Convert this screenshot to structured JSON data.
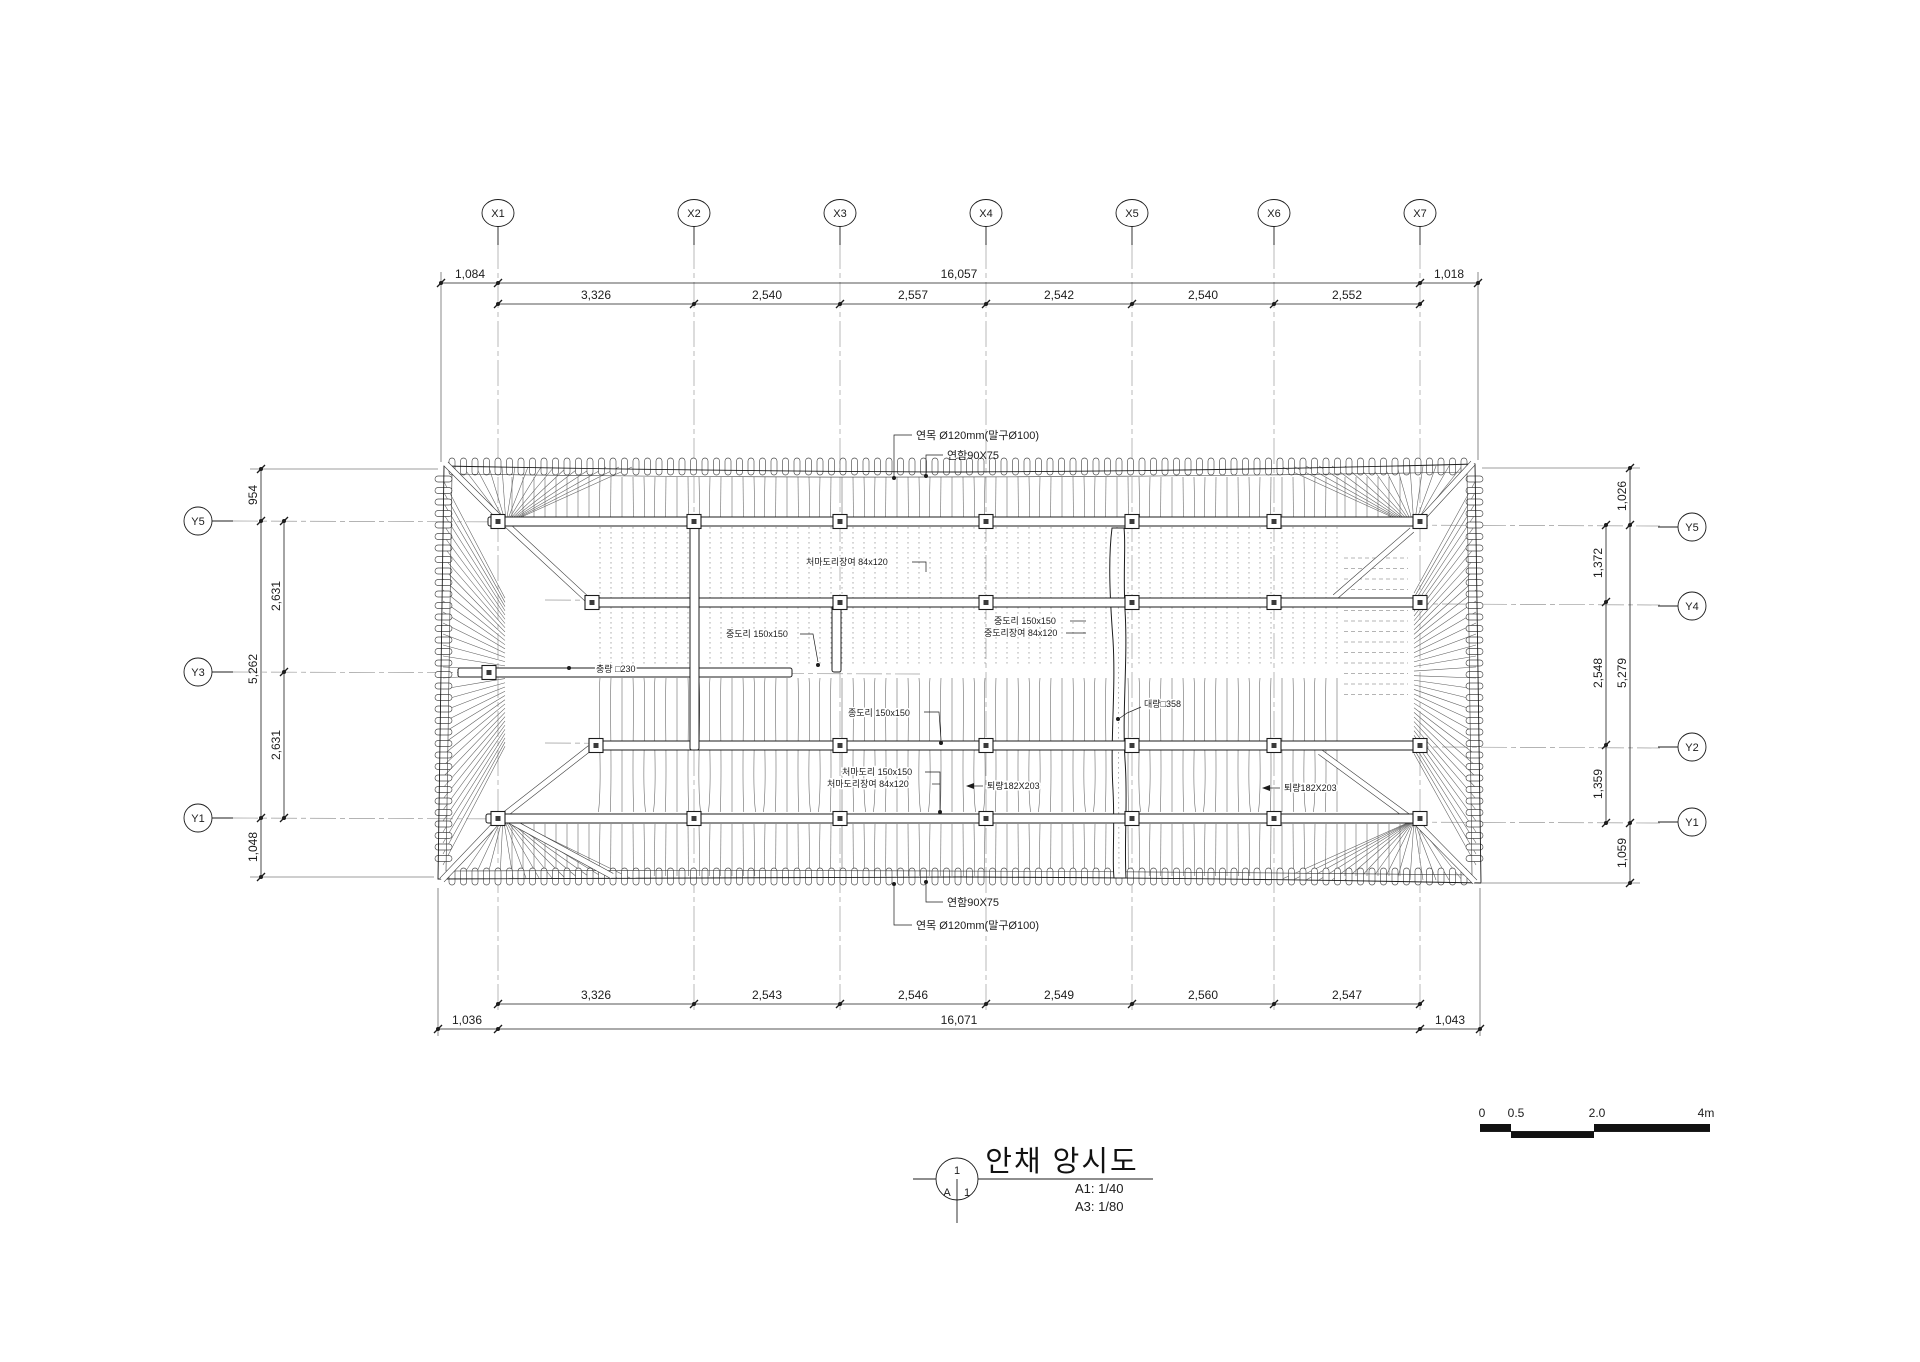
{
  "grid": {
    "x": [
      "X1",
      "X2",
      "X3",
      "X4",
      "X5",
      "X6",
      "X7"
    ],
    "y_left": [
      "Y5",
      "Y3",
      "Y1"
    ],
    "y_right": [
      "Y5",
      "Y4",
      "Y2",
      "Y1"
    ]
  },
  "dims": {
    "top_outer": [
      "1,084",
      "16,057",
      "1,018"
    ],
    "top_inner": [
      "3,326",
      "2,540",
      "2,557",
      "2,542",
      "2,540",
      "2,552"
    ],
    "bottom_inner": [
      "3,326",
      "2,543",
      "2,546",
      "2,549",
      "2,560",
      "2,547"
    ],
    "bottom_outer": [
      "1,036",
      "16,071",
      "1,043"
    ],
    "left_outer": [
      "954",
      "5,262",
      "1,048"
    ],
    "left_inner": [
      "2,631",
      "2,631"
    ],
    "right_inner": [
      "1,372",
      "2,548",
      "1,359"
    ],
    "right_outer": [
      "1,026",
      "5,279",
      "1,059"
    ]
  },
  "ann": {
    "top_rafter": "연목 Ø120mm(말구Ø100)",
    "top_fascia": "연함90X75",
    "bottom_fascia": "연함90X75",
    "bottom_rafter": "연목 Ø120mm(말구Ø100)",
    "eave_purlin_support_top": "처마도리장여 84x120",
    "mid_purlin_left": "중도리 150x150",
    "mid_purlin_right": "중도리 150x150",
    "mid_purlin_support": "중도리장여 84x120",
    "chungryang": "충량 □230",
    "ridge_purlin": "종도리 150x150",
    "daeryang": "대량□358",
    "eave_purlin_bottom": "처마도리 150x150",
    "eave_purlin_support_bottom": "처마도리장여 84x120",
    "toeryang_mid": "퇴량182X203",
    "toeryang_right": "퇴량182X203"
  },
  "title_block": {
    "figure_no": "1",
    "sheet_letter": "A",
    "sheet_index": "1",
    "title": "안채 앙시도",
    "scale_a1": "A1: 1/40",
    "scale_a3": "A3: 1/80"
  },
  "scale_bar": {
    "labels": [
      "0",
      "0.5",
      "2.0",
      "4m"
    ]
  }
}
